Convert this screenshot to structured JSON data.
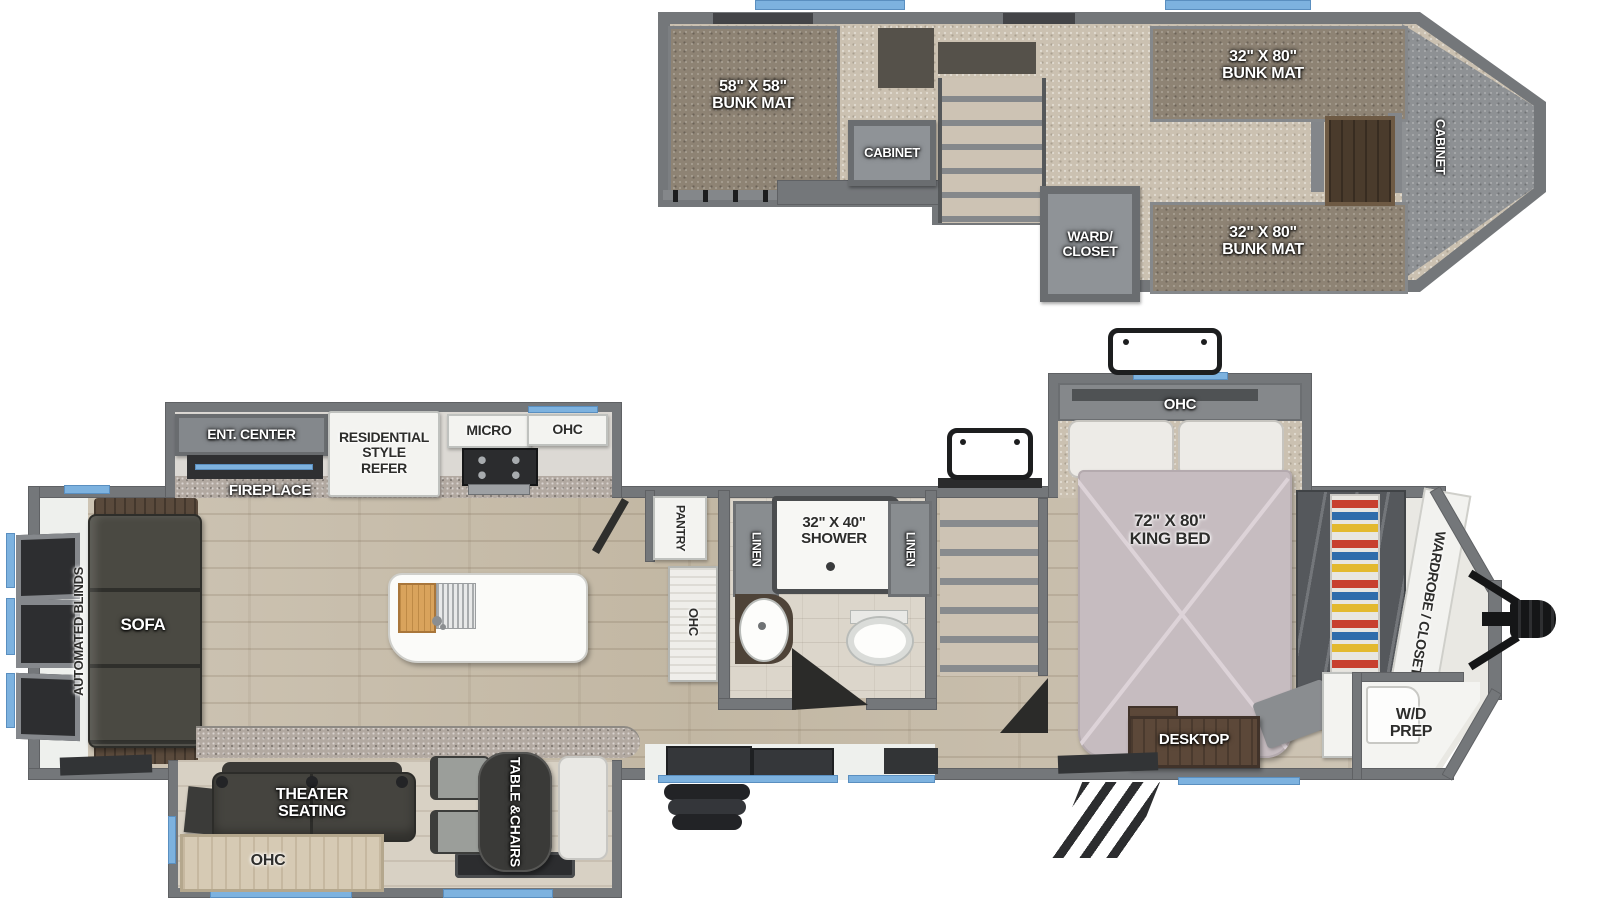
{
  "colors": {
    "wall": "#74777a",
    "carpet": "#cbc1b1",
    "bunk_mat": "#8e8374",
    "wood_floor": "#c9bfae",
    "window_accent": "#7db2df",
    "dark_furniture": "#45443f",
    "cabinet_white": "#f3f3f0",
    "wood_brown": "#5c4839",
    "bed": "#c6bcc0",
    "gray_box": "#8f9397"
  },
  "upper_deck": {
    "bunk_mat_left": {
      "line1": "58\" X 58\"",
      "line2": "BUNK MAT"
    },
    "cabinet": "CABINET",
    "ward_closet": {
      "line1": "WARD/",
      "line2": "CLOSET"
    },
    "bunk_mat_top": {
      "line1": "32\" X 80\"",
      "line2": "BUNK MAT"
    },
    "bunk_mat_bottom": {
      "line1": "32\" X 80\"",
      "line2": "BUNK MAT"
    },
    "cabinet_front": "CABINET"
  },
  "main_floor": {
    "automated_blinds": "AUTOMATED BLINDS",
    "sofa": "SOFA",
    "ent_center": "ENT. CENTER",
    "fireplace": "FIREPLACE",
    "refer": {
      "line1": "RESIDENTIAL",
      "line2": "STYLE",
      "line3": "REFER"
    },
    "micro": "MICRO",
    "ohc_kitchen": "OHC",
    "pantry": "PANTRY",
    "ohc_island": "OHC",
    "linen_left": "LINEN",
    "linen_right": "LINEN",
    "shower": {
      "line1": "32\" X 40\"",
      "line2": "SHOWER"
    },
    "ohc_bedroom": "OHC",
    "king_bed": {
      "line1": "72\" X 80\"",
      "line2": "KING BED"
    },
    "wardrobe_closet": "WARDROBE / CLOSET",
    "desktop": "DESKTOP",
    "wd_prep": {
      "line1": "W/D",
      "line2": "PREP"
    },
    "theater_seating": {
      "line1": "THEATER",
      "line2": "SEATING"
    },
    "table_chairs": {
      "line1": "TABLE &",
      "line2": "CHAIRS"
    },
    "ohc_garage": "OHC"
  }
}
